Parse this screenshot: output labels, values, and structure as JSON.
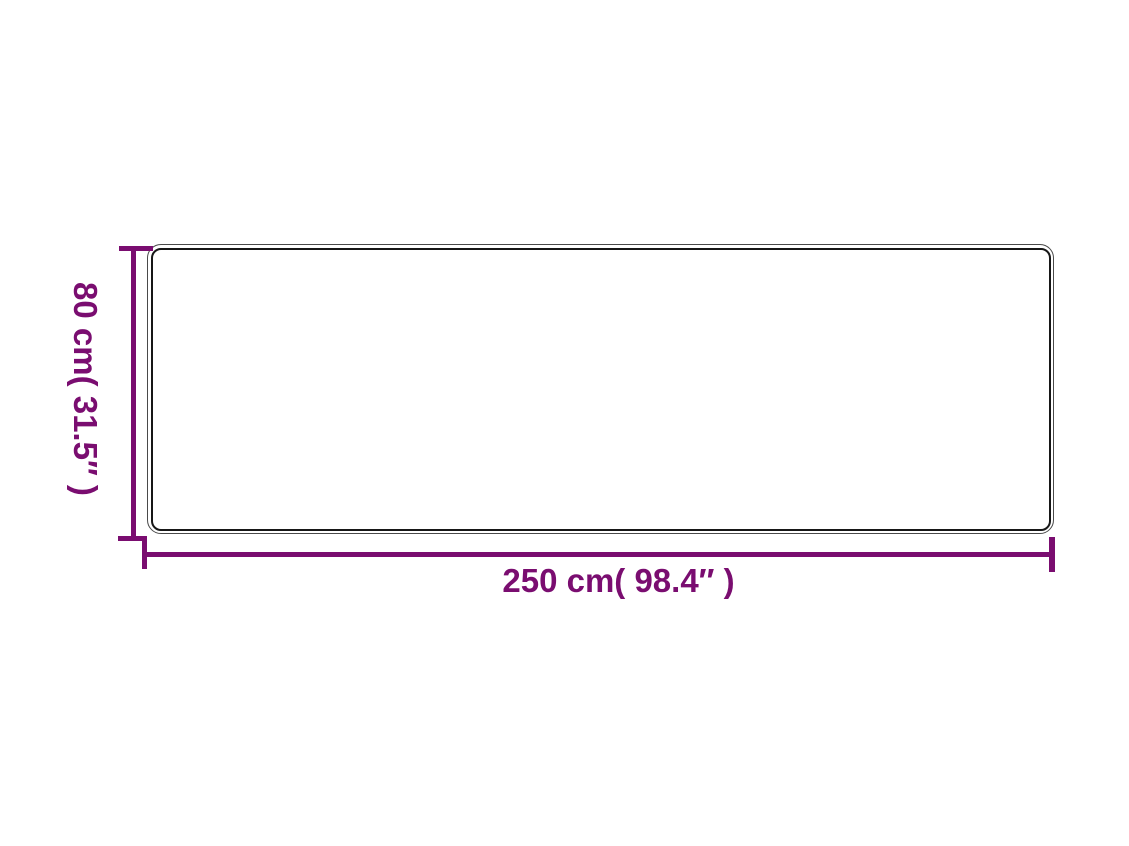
{
  "diagram": {
    "type": "product-dimension-diagram",
    "height_dimension": {
      "label": "80 cm( 31.5″ )",
      "value_cm": 80,
      "value_inches": 31.5
    },
    "width_dimension": {
      "label": "250 cm( 98.4″ )",
      "value_cm": 250,
      "value_inches": 98.4
    },
    "colors": {
      "dimension_accent": "#7A0D70",
      "outline_outer": "#4a4a4a",
      "outline_inner": "#171717",
      "background": "#ffffff"
    }
  }
}
